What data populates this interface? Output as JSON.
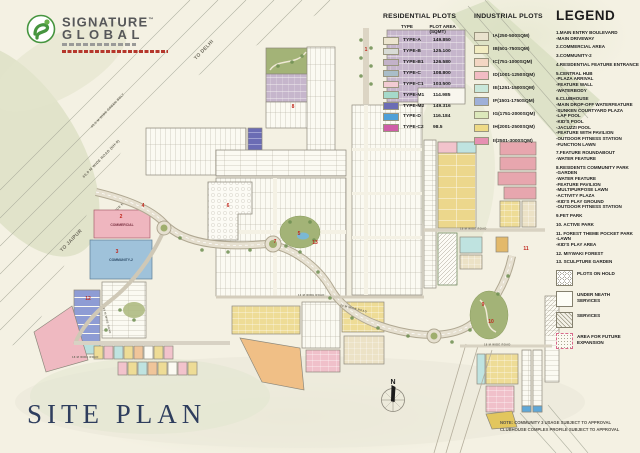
{
  "brand": {
    "line1": "SIGNATURE",
    "tm": "™",
    "line2": "GLOBAL"
  },
  "colors": {
    "brand_green": "#46953f",
    "title_navy": "#2f3e5e",
    "marker_red": "#c0281e",
    "paper": "#f4f1e3"
  },
  "title": "SITE PLAN",
  "note": {
    "line1": "NOTE: COMMUNITY 3 USAGE SUBJECT TO APPROVAL",
    "line2": "CLUBHOUSE COMPLEX PROFILE SUBJECT TO APPROVAL"
  },
  "residential": {
    "title": "RESIDENTIAL PLOTS",
    "col_type": "TYPE",
    "col_area": "PLOT AREA (SQMT)",
    "rows": [
      {
        "type": "TYPE-A",
        "area": "149.850",
        "color": "#ece5cf"
      },
      {
        "type": "TYPE-B",
        "area": "125.100",
        "color": "#d8dbd6"
      },
      {
        "type": "TYPE-B1",
        "area": "126.580",
        "color": "#c3b2c8"
      },
      {
        "type": "TYPE-C",
        "area": "108.800",
        "color": "#a9bdc8"
      },
      {
        "type": "TYPE-C1",
        "area": "103.500",
        "color": "#f2cbd3"
      },
      {
        "type": "TYPE-M1",
        "area": "114.985",
        "color": "#a5d9ca"
      },
      {
        "type": "TYPE-M2",
        "area": "149.316",
        "color": "#6b6cb4"
      },
      {
        "type": "TYPE-D",
        "area": "116.184",
        "color": "#4fa0d8"
      },
      {
        "type": "TYPE-C2",
        "area": "98.5",
        "color": "#cf5da8"
      }
    ]
  },
  "industrial": {
    "title": "INDUSTRIAL PLOTS",
    "rows": [
      {
        "label": "IA(250-500SQM)",
        "color": "#e9e2cd"
      },
      {
        "label": "IB(501-750SQM)",
        "color": "#f2ecc2"
      },
      {
        "label": "IC(751-1000SQM)",
        "color": "#f3d6c3"
      },
      {
        "label": "ID(1001-1250SQM)",
        "color": "#f2bcc4"
      },
      {
        "label": "IE(1251-1500SQM)",
        "color": "#c9e7da"
      },
      {
        "label": "IF(1501-1750SQM)",
        "color": "#9fb0d8"
      },
      {
        "label": "IG(1751-2000SQM)",
        "color": "#dce8bb"
      },
      {
        "label": "IH(2001-2500SQM)",
        "color": "#eeda86"
      },
      {
        "label": "II(2501-3000SQM)",
        "color": "#e690b2"
      }
    ]
  },
  "legend": {
    "title": "LEGEND",
    "lines": [
      {
        "t": "1.MAIN ENTRY BOULEVARD"
      },
      {
        "t": "-MAIN DRIVEWAY"
      },
      {
        "t": "2.COMMERCIAL AREA",
        "cls": "g"
      },
      {
        "t": "3.COMMUNITY-2",
        "cls": "g"
      },
      {
        "t": "4.RESIDENTIAL FEATURE ENTRANCE",
        "cls": "g"
      },
      {
        "t": "5.CENTRAL HUB",
        "cls": "g"
      },
      {
        "t": "-PLAZA ARRIVAL"
      },
      {
        "t": "-FEATURE WALL"
      },
      {
        "t": "-WATERBODY"
      },
      {
        "t": "6.CLUBHOUSE",
        "cls": "g"
      },
      {
        "t": "-MAIN DROP-OFF WATERFEATURE"
      },
      {
        "t": "-SUNKEN COURTYARD PLAZA"
      },
      {
        "t": "-LAP POOL"
      },
      {
        "t": "-KID'S POOL"
      },
      {
        "t": "-JACUZZI POOL"
      },
      {
        "t": "-FEATURE WITH PAVILION"
      },
      {
        "t": "-OUTDOOR FITNESS STATION"
      },
      {
        "t": "-FUNCTION LAWN"
      },
      {
        "t": "7.FEATURE ROUNDABOUT",
        "cls": "g"
      },
      {
        "t": "-WATER FEATURE"
      },
      {
        "t": "8.RESIDENTS COMMUNITY PARK",
        "cls": "g"
      },
      {
        "t": "-GARDEN"
      },
      {
        "t": "-WATER FEATURE"
      },
      {
        "t": "-FEATURE PAVILION"
      },
      {
        "t": "-MULTIPURPOSE LAWN"
      },
      {
        "t": "-ACTIVITY PLAZA"
      },
      {
        "t": "-KID'S PLAY GROUND"
      },
      {
        "t": "-OUTDOOR FITNESS STATION"
      },
      {
        "t": "9.PET PARK",
        "cls": "g"
      },
      {
        "t": "10. ACTIVE PARK",
        "cls": "g"
      },
      {
        "t": "11. FOREST THEME POCKET PARK",
        "cls": "g"
      },
      {
        "t": "-LAWN"
      },
      {
        "t": "-KID'S PLAY AREA"
      },
      {
        "t": "12. MIYWAKI FOREST",
        "cls": "g"
      },
      {
        "t": "13. SCULPTURE GARDEN",
        "cls": "g"
      }
    ],
    "patterns": [
      {
        "label": "PLOTS ON HOLD",
        "pattern": "pat-hex"
      },
      {
        "label": "UNDER NEATH SERVICES",
        "pattern": "pat-plain"
      },
      {
        "label": "SERVICES",
        "pattern": "pat-hatch"
      },
      {
        "label": "AREA FOR FUTURE EXPANSION",
        "pattern": "pat-dots"
      }
    ]
  },
  "map": {
    "compass_n": "N",
    "roads": {
      "to_delhi": "TO DELHI",
      "to_jaipur": "TO JAIPUR",
      "green_belt": "45.0 M WIDE GREEN BELT",
      "nh8": "60.0 M WIDE ROAD (NH-8)",
      "service": "SERVICE ROAD",
      "r18": "18 M WIDE ROAD",
      "r24": "24 M WIDE ROAD",
      "r12": "12 M WIDE ROAD"
    },
    "areas": {
      "commercial": "COMMERCIAL",
      "community2": "COMMUNITY-2"
    },
    "markers": [
      {
        "n": "1",
        "x": 366,
        "y": 50
      },
      {
        "n": "2",
        "x": 121,
        "y": 217
      },
      {
        "n": "3",
        "x": 117,
        "y": 252
      },
      {
        "n": "4",
        "x": 143,
        "y": 206
      },
      {
        "n": "5",
        "x": 299,
        "y": 234
      },
      {
        "n": "6",
        "x": 228,
        "y": 206
      },
      {
        "n": "7",
        "x": 275,
        "y": 242
      },
      {
        "n": "8",
        "x": 293,
        "y": 107
      },
      {
        "n": "9",
        "x": 483,
        "y": 305
      },
      {
        "n": "10",
        "x": 491,
        "y": 322
      },
      {
        "n": "11",
        "x": 526,
        "y": 249
      },
      {
        "n": "12",
        "x": 88,
        "y": 299
      },
      {
        "n": "13",
        "x": 315,
        "y": 243
      }
    ]
  }
}
